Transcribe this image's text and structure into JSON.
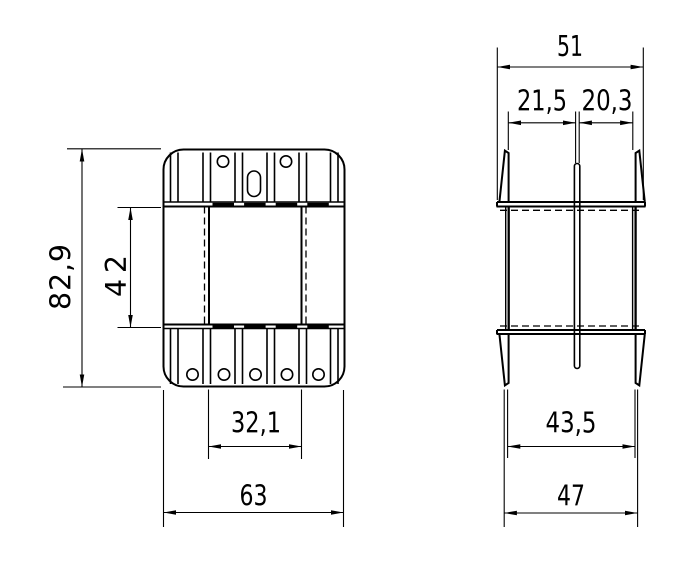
{
  "drawing": {
    "kind": "two-view technical drawing of a bobbin / flanged part",
    "colors": {
      "background": "#ffffff",
      "lines": "#000000"
    },
    "views": {
      "left": "front view",
      "right": "side view"
    },
    "dims": {
      "overall_height": "82,9",
      "window_height": "42",
      "window_width": "32,1",
      "overall_width": "63",
      "side_width": "51",
      "left_span": "21,5",
      "right_span": "20,3",
      "flange_span": "43,5",
      "pin_span": "47"
    }
  }
}
